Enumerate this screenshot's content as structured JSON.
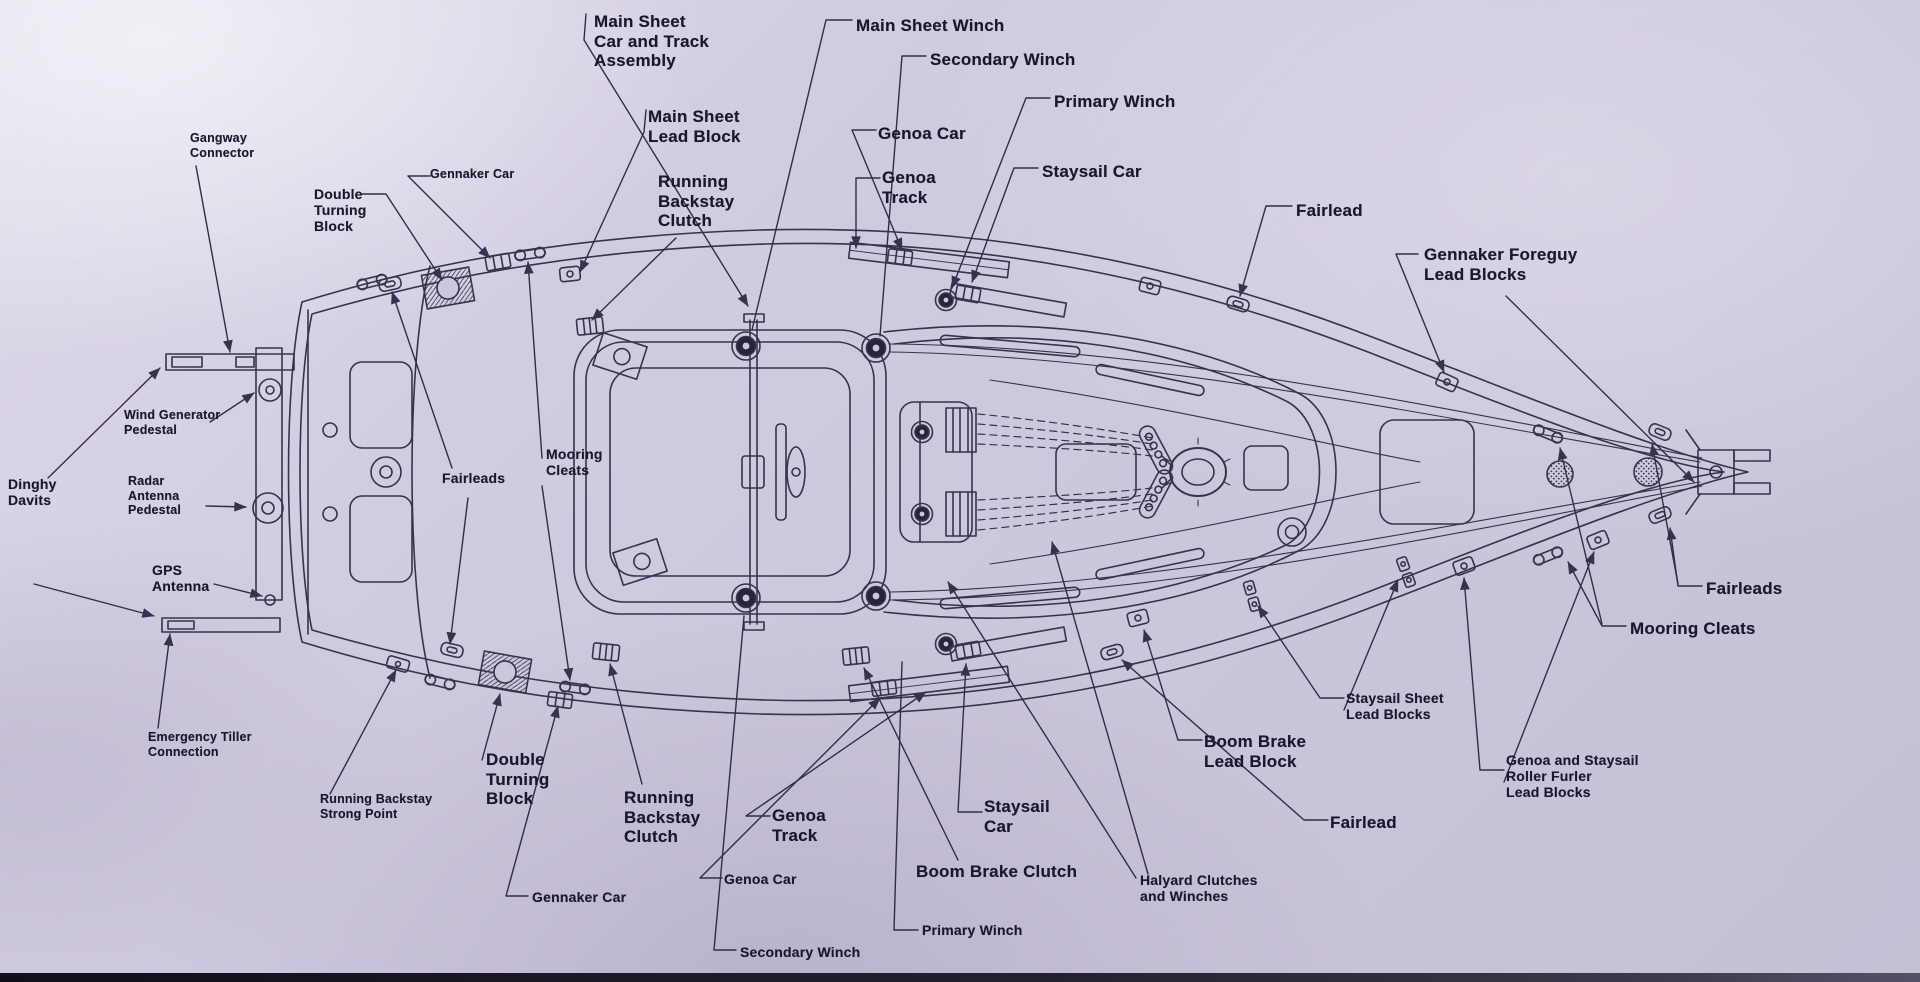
{
  "diagram": {
    "subject": "sailboat deck hardware plan",
    "colors": {
      "paper": "#cdc7dd",
      "ink": "#34344e",
      "label_ink": "#171930",
      "bottom_edge": "#23212f"
    }
  },
  "labels": [
    {
      "id": "gangway-connector",
      "text": "Gangway\nConnector"
    },
    {
      "id": "double-turning-block-top",
      "text": "Double\nTurning\nBlock"
    },
    {
      "id": "gennaker-car-top",
      "text": "Gennaker Car"
    },
    {
      "id": "main-sheet-car-track",
      "text": "Main Sheet\nCar and Track\nAssembly"
    },
    {
      "id": "main-sheet-lead-block",
      "text": "Main Sheet\nLead Block"
    },
    {
      "id": "running-backstay-clutch-top",
      "text": "Running\nBackstay\nClutch"
    },
    {
      "id": "main-sheet-winch",
      "text": "Main Sheet Winch"
    },
    {
      "id": "secondary-winch-top",
      "text": "Secondary Winch"
    },
    {
      "id": "genoa-car-top",
      "text": "Genoa Car"
    },
    {
      "id": "genoa-track-top",
      "text": "Genoa\nTrack"
    },
    {
      "id": "primary-winch-top",
      "text": "Primary Winch"
    },
    {
      "id": "staysail-car-top",
      "text": "Staysail Car"
    },
    {
      "id": "fairlead-top",
      "text": "Fairlead"
    },
    {
      "id": "gennaker-foreguy-lead-blocks",
      "text": "Gennaker Foreguy\nLead Blocks"
    },
    {
      "id": "wind-generator-pedestal",
      "text": "Wind Generator\nPedestal"
    },
    {
      "id": "dinghy-davits",
      "text": "Dinghy\nDavits"
    },
    {
      "id": "radar-antenna-pedestal",
      "text": "Radar\nAntenna\nPedestal"
    },
    {
      "id": "gps-antenna",
      "text": "GPS\nAntenna"
    },
    {
      "id": "emergency-tiller-connection",
      "text": "Emergency Tiller\nConnection"
    },
    {
      "id": "running-backstay-strong-point",
      "text": "Running Backstay\nStrong Point"
    },
    {
      "id": "fairleads-mid",
      "text": "Fairleads"
    },
    {
      "id": "mooring-cleats-mid",
      "text": "Mooring\nCleats"
    },
    {
      "id": "double-turning-block-bottom",
      "text": "Double\nTurning\nBlock"
    },
    {
      "id": "gennaker-car-bottom",
      "text": "Gennaker Car"
    },
    {
      "id": "running-backstay-clutch-bottom",
      "text": "Running\nBackstay\nClutch"
    },
    {
      "id": "genoa-car-bottom",
      "text": "Genoa Car"
    },
    {
      "id": "genoa-track-bottom",
      "text": "Genoa\nTrack"
    },
    {
      "id": "secondary-winch-bottom",
      "text": "Secondary Winch"
    },
    {
      "id": "primary-winch-bottom",
      "text": "Primary Winch"
    },
    {
      "id": "boom-brake-clutch",
      "text": "Boom Brake Clutch"
    },
    {
      "id": "staysail-car-bottom",
      "text": "Staysail\nCar"
    },
    {
      "id": "halyard-clutches-winches",
      "text": "Halyard Clutches\nand Winches"
    },
    {
      "id": "boom-brake-lead-block",
      "text": "Boom Brake\nLead Block"
    },
    {
      "id": "staysail-sheet-lead-blocks",
      "text": "Staysail Sheet\nLead Blocks"
    },
    {
      "id": "genoa-staysail-roller-furler",
      "text": "Genoa and Staysail\nRoller Furler\nLead Blocks"
    },
    {
      "id": "fairlead-bottom",
      "text": "Fairlead"
    },
    {
      "id": "fairleads-right",
      "text": "Fairleads"
    },
    {
      "id": "mooring-cleats-right",
      "text": "Mooring Cleats"
    }
  ]
}
